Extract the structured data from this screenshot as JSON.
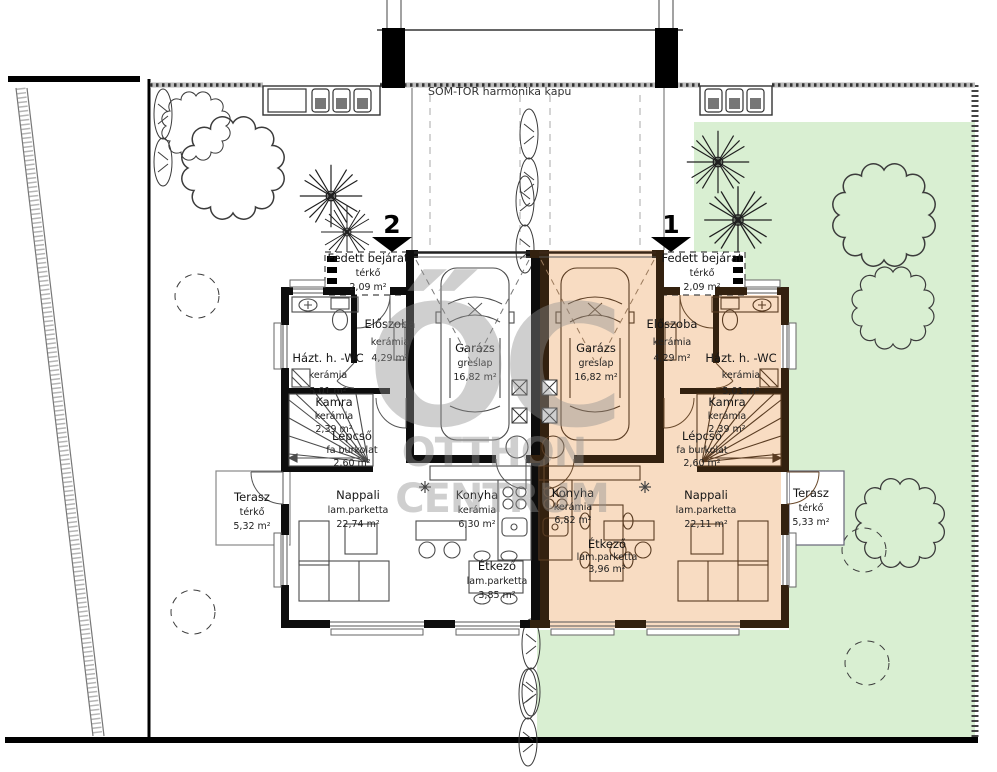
{
  "site": {
    "gate_label": "SOM-TOR  harmónika kapu"
  },
  "watermark": {
    "logo": "ŐC",
    "line1": "OTTHON",
    "line2": "CENTRUM"
  },
  "units": {
    "left": {
      "marker": "2",
      "fedett_bejarat": {
        "name": "Fedett bejárat",
        "material": "térkő",
        "area": "2,09 m²"
      },
      "eloszoba": {
        "name": "Előszoba",
        "material": "kerámia",
        "area": "4,29 m²"
      },
      "hazt_wc": {
        "name": "Házt. h. -WC",
        "material": "kerámia",
        "area": "5,01 m²"
      },
      "kamra": {
        "name": "Kamra",
        "material": "kerámia",
        "area": "2,39 m²"
      },
      "lepcso": {
        "name": "Lépcső",
        "material": "fa burkolat",
        "area": "2,60 m²"
      },
      "garazs": {
        "name": "Garázs",
        "material": "greslap",
        "area": "16,82 m²"
      },
      "nappali": {
        "name": "Nappali",
        "material": "lam.parketta",
        "area": "22,74 m²"
      },
      "konyha": {
        "name": "Konyha",
        "material": "kerámia",
        "area": "6,30 m²"
      },
      "etkezo": {
        "name": "Étkező",
        "material": "lam.parketta",
        "area": "3,85 m²"
      },
      "terasz": {
        "name": "Terasz",
        "material": "térkő",
        "area": "5,32 m²"
      }
    },
    "right": {
      "marker": "1",
      "fedett_bejarat": {
        "name": "Fedett bejárat",
        "material": "térkő",
        "area": "2,09 m²"
      },
      "eloszoba": {
        "name": "Előszoba",
        "material": "kerámia",
        "area": "4,29 m²"
      },
      "hazt_wc": {
        "name": "Házt. h. -WC",
        "material": "kerámia",
        "area": "5,01 m²"
      },
      "kamra": {
        "name": "Kamra",
        "material": "kerámia",
        "area": "2,39 m²"
      },
      "lepcso": {
        "name": "Lépcső",
        "material": "fa burkolat",
        "area": "2,60 m²"
      },
      "garazs": {
        "name": "Garázs",
        "material": "greslap",
        "area": "16,82 m²"
      },
      "nappali": {
        "name": "Nappali",
        "material": "lam.parketta",
        "area": "22,11 m²"
      },
      "konyha": {
        "name": "Konyha",
        "material": "kerámia",
        "area": "6,82 m²"
      },
      "etkezo": {
        "name": "Étkező",
        "material": "lam.parketta",
        "area": "3,96 m²"
      },
      "terasz": {
        "name": "Terasz",
        "material": "térkő",
        "area": "5,33 m²"
      }
    }
  },
  "colors": {
    "garden": "#d9efd2",
    "highlight_unit": "#f8dcc2",
    "wall_left": "#0d0d0d",
    "wall_right": "#33210f"
  }
}
